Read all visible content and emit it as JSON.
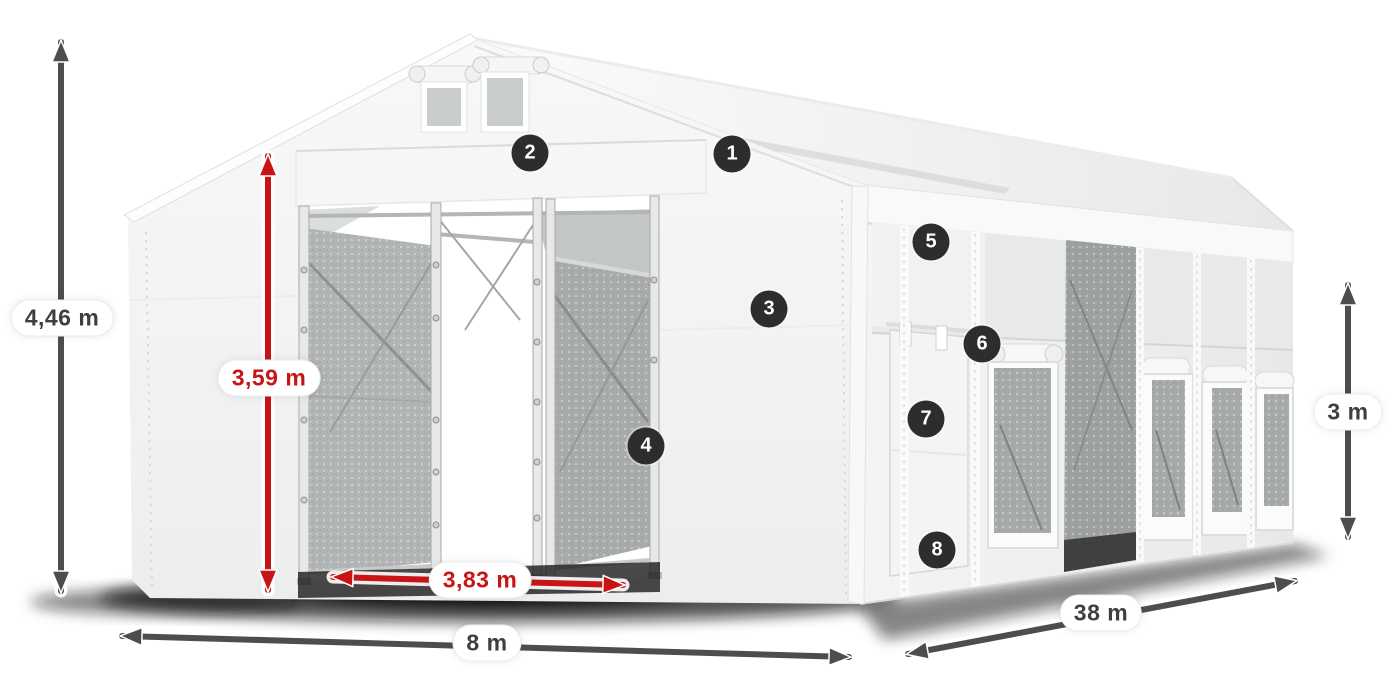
{
  "diagram": {
    "dimensions": {
      "total_height": "4,46 m",
      "entrance_height": "3,59 m",
      "entrance_width": "3,83 m",
      "front_width": "8 m",
      "length": "38 m",
      "side_height": "3 m"
    },
    "callouts": [
      {
        "number": "1"
      },
      {
        "number": "2"
      },
      {
        "number": "3"
      },
      {
        "number": "4"
      },
      {
        "number": "5"
      },
      {
        "number": "6"
      },
      {
        "number": "7"
      },
      {
        "number": "8"
      }
    ],
    "colors": {
      "dimension_red": "#c81414",
      "dimension_dark": "#4d4d4d",
      "callout_background": "#2d2d2d",
      "callout_text": "#ffffff",
      "label_background": "#ffffff",
      "label_text": "#3f3f3f"
    }
  }
}
